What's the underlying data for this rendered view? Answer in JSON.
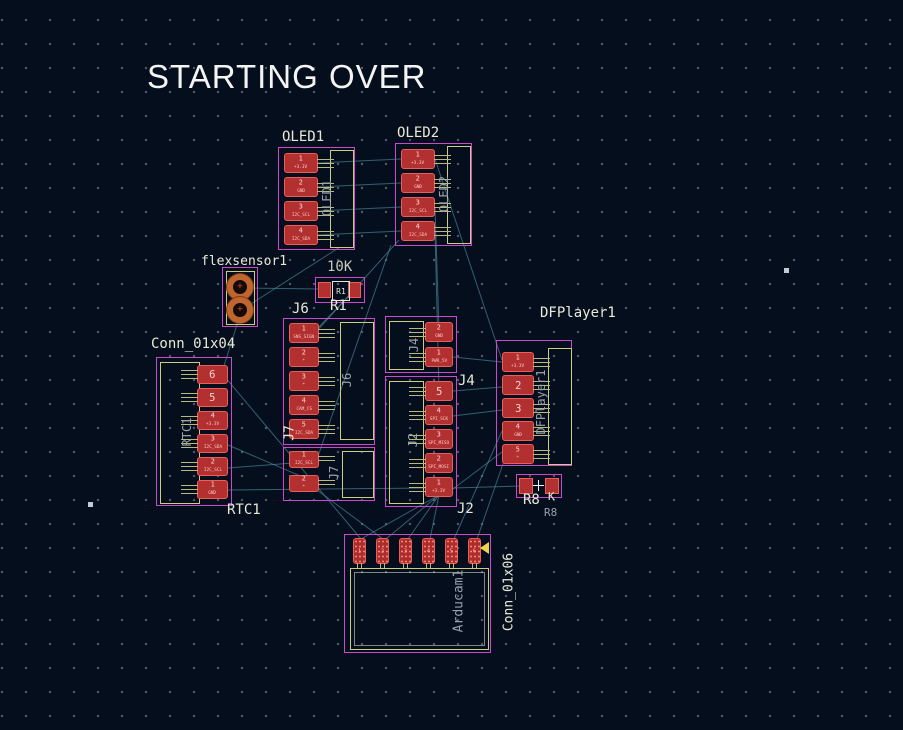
{
  "title": "STARTING OVER",
  "colors": {
    "background": "#050e1c",
    "pad_red": "#b33030",
    "pad_border": "#ef5c5c",
    "courtyard_yellow": "#cdcd82",
    "bounding_magenta": "#cc49ce",
    "silkscreen": "#e9e9d8",
    "fab_gray": "#98a1aa",
    "ratsnest_cyan": "#4e93a8"
  },
  "components": {
    "oled1": {
      "label": "OLED1",
      "ref": "OLED1",
      "pads": [
        {
          "n": "1",
          "net": "+3.3V"
        },
        {
          "n": "2",
          "net": "GND"
        },
        {
          "n": "3",
          "net": "I2C_SCL"
        },
        {
          "n": "4",
          "net": "I2C_SDA"
        }
      ]
    },
    "oled2": {
      "label": "OLED2",
      "ref": "OLED2",
      "pads": [
        {
          "n": "1",
          "net": "+3.3V"
        },
        {
          "n": "2",
          "net": "GND"
        },
        {
          "n": "3",
          "net": "I2C_SCL"
        },
        {
          "n": "4",
          "net": "I2C_SDA"
        }
      ]
    },
    "flexsensor": {
      "label": "flexsensor1"
    },
    "r1": {
      "value": "10K",
      "ref": "R1",
      "ref_inner": "R1"
    },
    "j6": {
      "label": "J6",
      "ref": "J6",
      "pads": [
        {
          "n": "1",
          "net": "SNS_SIGN"
        },
        {
          "n": "2",
          "net": "*"
        },
        {
          "n": "3",
          "net": "*"
        },
        {
          "n": "4",
          "net": "CAM_CS"
        },
        {
          "n": "5",
          "net": "I2C_SDA"
        }
      ]
    },
    "j7": {
      "label": "J7",
      "ref": "J7",
      "pads": [
        {
          "n": "1",
          "net": "I2C_SCL"
        },
        {
          "n": "2",
          "net": "*"
        }
      ]
    },
    "j4": {
      "label": "J4",
      "ref": "J4",
      "pads": [
        {
          "n": "2",
          "net": "GND"
        },
        {
          "n": "1",
          "net": "PWR_5V"
        }
      ]
    },
    "j2": {
      "label": "J2",
      "ref": "J2",
      "pads": [
        {
          "n": "5",
          "net": ""
        },
        {
          "n": "4",
          "net": "SPI_SCK"
        },
        {
          "n": "3",
          "net": "SPI_MISO"
        },
        {
          "n": "2",
          "net": "SPI_MOSI"
        },
        {
          "n": "1",
          "net": "+3.3V"
        }
      ]
    },
    "dfplayer": {
      "label": "DFPlayer1",
      "ref": "DFPlayer1",
      "pads": [
        {
          "n": "1",
          "net": "+3.3V"
        },
        {
          "n": "2",
          "net": ""
        },
        {
          "n": "3",
          "net": ""
        },
        {
          "n": "4",
          "net": "GND"
        },
        {
          "n": "5",
          "net": "*"
        }
      ]
    },
    "r8": {
      "ref": "R8",
      "value_tail": "K",
      "ref_fab": "R8"
    },
    "rtc": {
      "label": "Conn_01x04",
      "ref": "RTC1",
      "ref_bottom": "RTC1",
      "pads": [
        {
          "n": "6",
          "net": ""
        },
        {
          "n": "5",
          "net": ""
        },
        {
          "n": "4",
          "net": "+3.3V"
        },
        {
          "n": "3",
          "net": "I2C_SDA"
        },
        {
          "n": "2",
          "net": "I2C_SCL"
        },
        {
          "n": "1",
          "net": "GND"
        }
      ]
    },
    "arducam": {
      "ref": "Arducam1",
      "side_label": "Conn_01x06",
      "pads": [
        {
          "n": "1",
          "net": ""
        },
        {
          "n": "2",
          "net": ""
        },
        {
          "n": "3",
          "net": ""
        },
        {
          "n": "4",
          "net": ""
        },
        {
          "n": "5",
          "net": ""
        },
        {
          "n": "6",
          "net": ""
        }
      ]
    }
  },
  "ratsnest": [
    [
      318,
      163,
      401,
      159
    ],
    [
      318,
      187,
      401,
      183
    ],
    [
      318,
      211,
      401,
      207
    ],
    [
      318,
      235,
      401,
      231
    ],
    [
      435,
      159,
      502,
      360
    ],
    [
      435,
      207,
      439,
      330
    ],
    [
      435,
      231,
      439,
      389
    ],
    [
      399,
      240,
      315,
      333
    ],
    [
      391,
      245,
      317,
      459
    ],
    [
      340,
      247,
      243,
      309
    ],
    [
      240,
      288,
      320,
      289
    ],
    [
      355,
      290,
      315,
      331
    ],
    [
      241,
      312,
      222,
      372
    ],
    [
      225,
      377,
      361,
      539
    ],
    [
      228,
      445,
      319,
      484
    ],
    [
      228,
      468,
      319,
      461
    ],
    [
      228,
      490,
      425,
      488
    ],
    [
      439,
      495,
      361,
      539
    ],
    [
      439,
      495,
      386,
      539
    ],
    [
      439,
      495,
      408,
      539
    ],
    [
      439,
      495,
      430,
      539
    ],
    [
      453,
      488,
      523,
      486
    ],
    [
      453,
      489,
      502,
      452
    ],
    [
      502,
      431,
      454,
      539
    ],
    [
      505,
      458,
      477,
      539
    ],
    [
      317,
      490,
      383,
      539
    ],
    [
      453,
      391,
      502,
      387
    ],
    [
      453,
      416,
      502,
      410
    ],
    [
      453,
      357,
      502,
      362
    ]
  ]
}
